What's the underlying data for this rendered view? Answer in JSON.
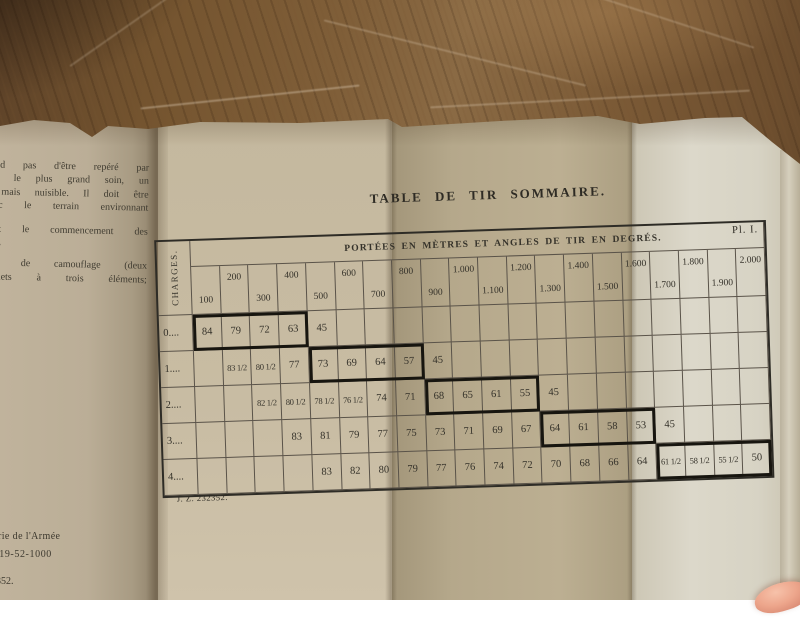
{
  "colors": {
    "wood": "#7a5836",
    "left_page_paper": "#bbae97",
    "page_band_left": "#c6ba a1",
    "page_band_middle": "#b5a88b",
    "page_band_right": "#d9d4c5",
    "ink": "#2e2b24",
    "grid_line": "#5a5349",
    "zone_border": "#17150f",
    "fingertip": "#eda68c"
  },
  "left_page": {
    "lines": [
      "ttend pas d'être repéré par",
      "vec le plus grand soin, un",
      ", mais nuisible. Il doit être",
      "avec le terrain environnant",
      "vant le commencement des",
      "erie,",
      "lets de camouflage (deux",
      "piquets à trois éléments;"
    ],
    "imprint": {
      "line1": "airie de l'Armée",
      "line2": "119-52-1000",
      "line3": "352."
    }
  },
  "plate": {
    "title": "TABLE DE TIR SOMMAIRE.",
    "plate_number": "Pl. I.",
    "print_ref": "J. Z. 232352.",
    "table": {
      "corner_header": "CHARGES.",
      "span_header": "PORTÉES EN MÈTRES ET ANGLES DE TIR EN DEGRÉS.",
      "columns": [
        "100",
        "200",
        "300",
        "400",
        "500",
        "600",
        "700",
        "800",
        "900",
        "1.000",
        "1.100",
        "1.200",
        "1.300",
        "1.400",
        "1.500",
        "1.600",
        "1.700",
        "1.800",
        "1.900",
        "2.000"
      ],
      "rows": [
        {
          "label": "0....",
          "zone": [
            0,
            3
          ],
          "cells": [
            "84",
            "79",
            "72",
            "63",
            "45",
            "",
            "",
            "",
            "",
            "",
            "",
            "",
            "",
            "",
            "",
            "",
            "",
            "",
            "",
            ""
          ]
        },
        {
          "label": "1....",
          "zone": [
            4,
            7
          ],
          "cells": [
            "",
            "83 1/2",
            "80 1/2",
            "77",
            "73",
            "69",
            "64",
            "57",
            "45",
            "",
            "",
            "",
            "",
            "",
            "",
            "",
            "",
            "",
            "",
            ""
          ]
        },
        {
          "label": "2....",
          "zone": [
            8,
            11
          ],
          "cells": [
            "",
            "",
            "82 1/2",
            "80 1/2",
            "78 1/2",
            "76 1/2",
            "74",
            "71",
            "68",
            "65",
            "61",
            "55",
            "45",
            "",
            "",
            "",
            "",
            "",
            "",
            ""
          ]
        },
        {
          "label": "3....",
          "zone": [
            12,
            15
          ],
          "cells": [
            "",
            "",
            "",
            "83",
            "81",
            "79",
            "77",
            "75",
            "73",
            "71",
            "69",
            "67",
            "64",
            "61",
            "58",
            "53",
            "45",
            "",
            "",
            ""
          ]
        },
        {
          "label": "4....",
          "zone": [
            16,
            19
          ],
          "cells": [
            "",
            "",
            "",
            "",
            "83",
            "82",
            "80",
            "79",
            "77",
            "76",
            "74",
            "72",
            "70",
            "68",
            "66",
            "64",
            "61 1/2",
            "58 1/2",
            "55 1/2",
            "50"
          ]
        }
      ]
    }
  }
}
